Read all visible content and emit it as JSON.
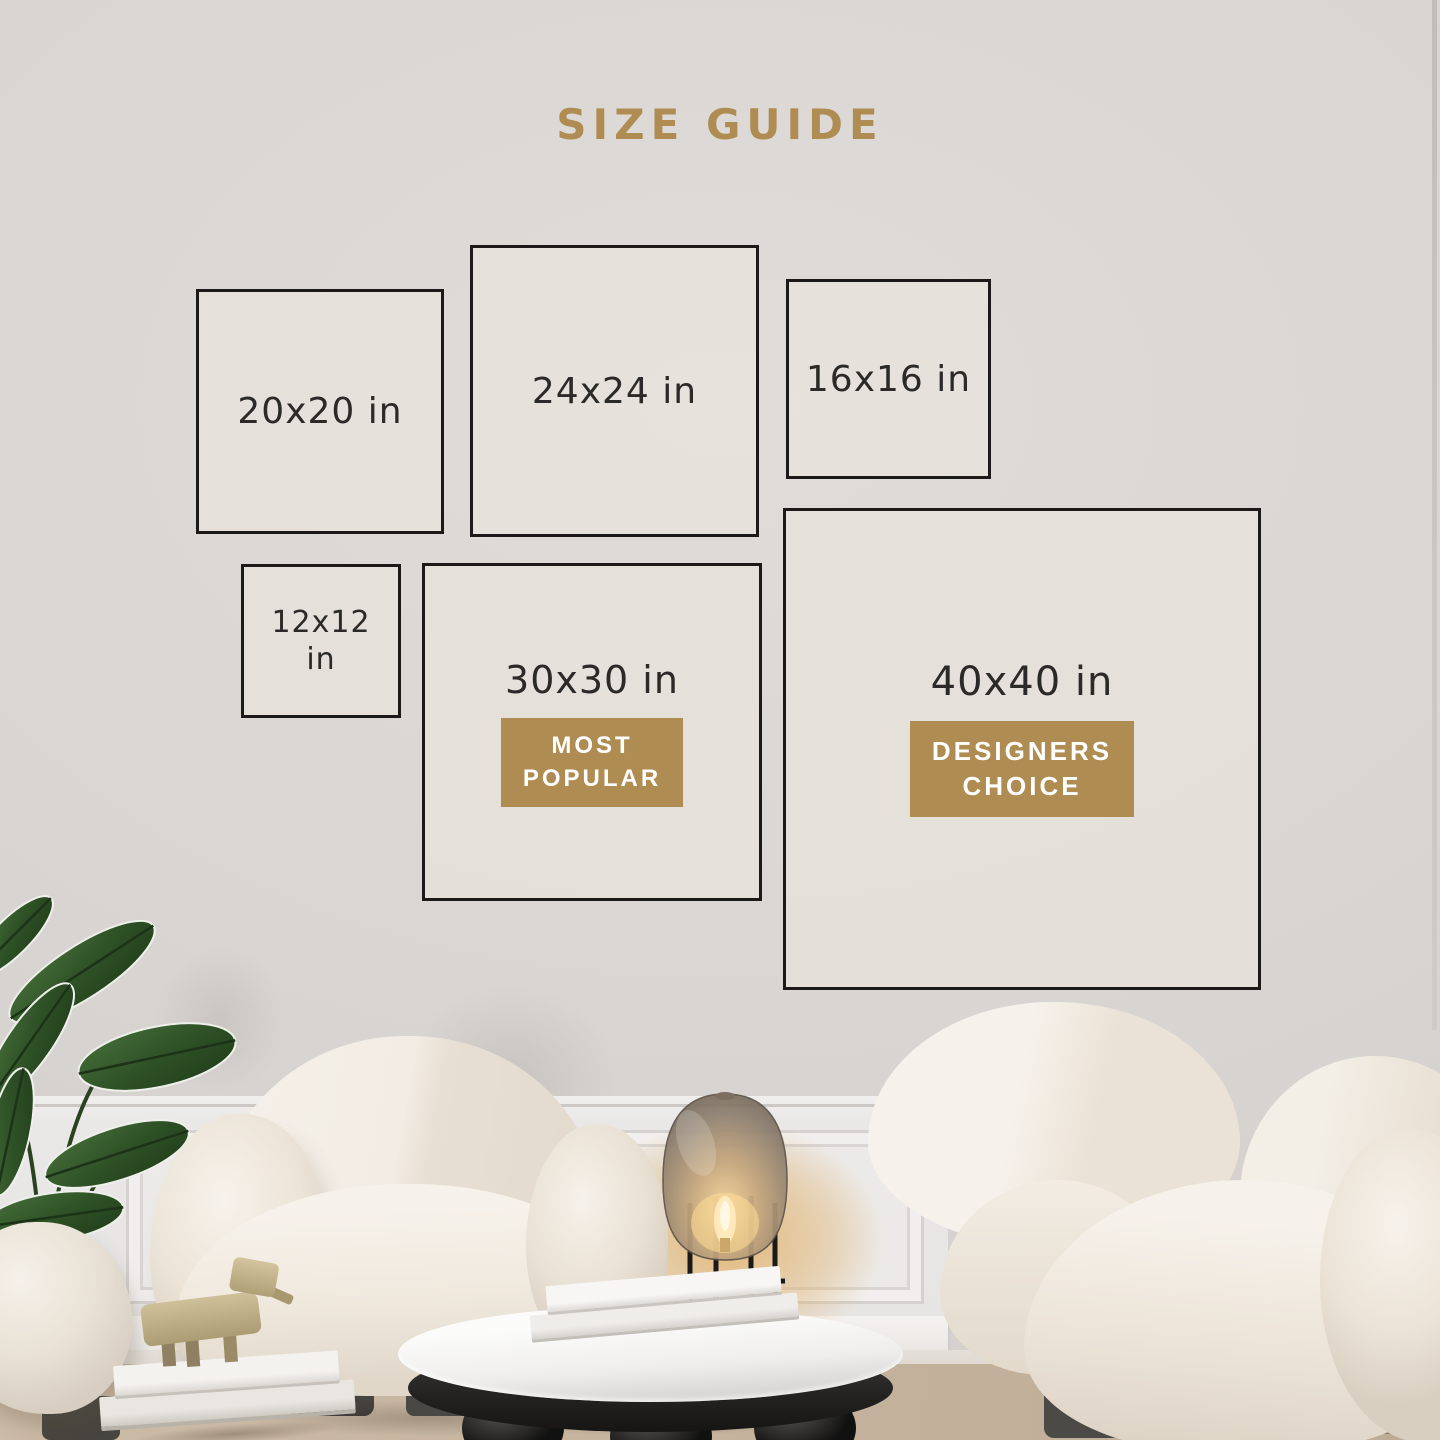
{
  "theme": {
    "accent": "#af8c51",
    "boxBorder": "#1b1a18",
    "labelColor": "#2b2a28",
    "badgeText": "#ffffff",
    "wall": "#d8d4d1"
  },
  "header": {
    "title": "SIZE GUIDE"
  },
  "size_guide": {
    "boxes": [
      {
        "label": "20x20 in"
      },
      {
        "label": "24x24 in"
      },
      {
        "label": "16x16 in"
      },
      {
        "label": "12x12 in"
      },
      {
        "label": "30x30 in",
        "badge_line1": "MOST",
        "badge_line2": "POPULAR"
      },
      {
        "label": "40x40 in",
        "badge_line1": "DESIGNERS",
        "badge_line2": "CHOICE"
      }
    ]
  },
  "scene": {
    "objects": [
      "potted-plant",
      "ottoman",
      "armchair",
      "floor-lamp",
      "coffee-table",
      "stacked-books",
      "wood-animal-figurine",
      "sofa",
      "wainscoting",
      "rug"
    ]
  }
}
